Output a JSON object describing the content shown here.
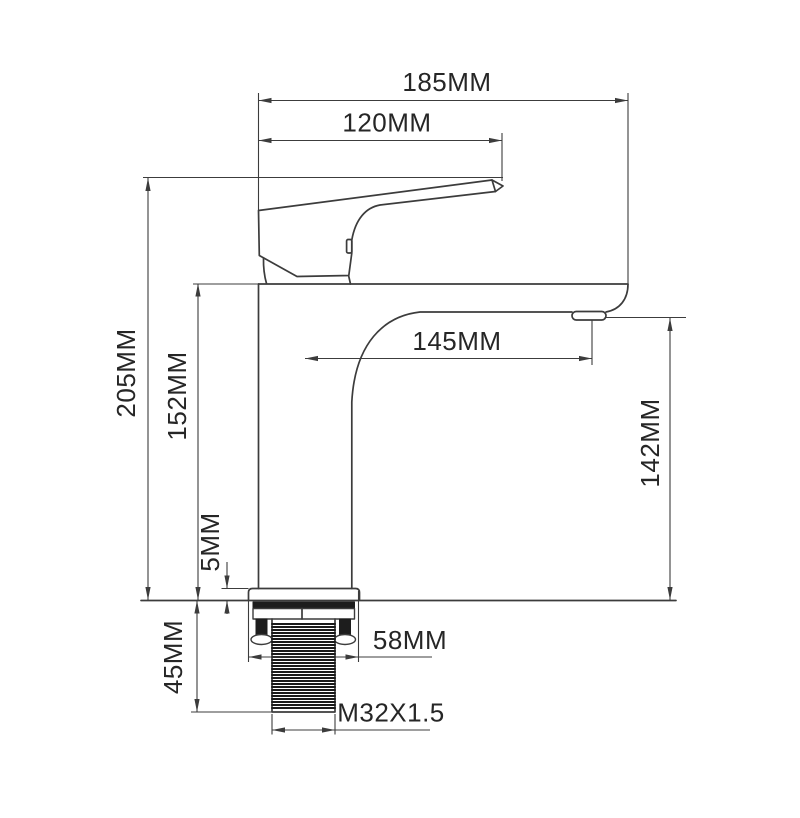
{
  "drawing": {
    "background": "#ffffff",
    "line_color": "#3c3c3c",
    "text_color": "#262626",
    "hardware_fill": "#1d1d1d",
    "dimensions": {
      "overall_depth": "185MM",
      "handle_reach": "120MM",
      "overall_height": "205MM",
      "body_top_height": "152MM",
      "deck_plate_height": "5MM",
      "under_deck_depth": "45MM",
      "spout_reach": "145MM",
      "spout_outlet_height": "142MM",
      "base_width": "58MM",
      "thread_spec": "M32X1.5"
    }
  }
}
